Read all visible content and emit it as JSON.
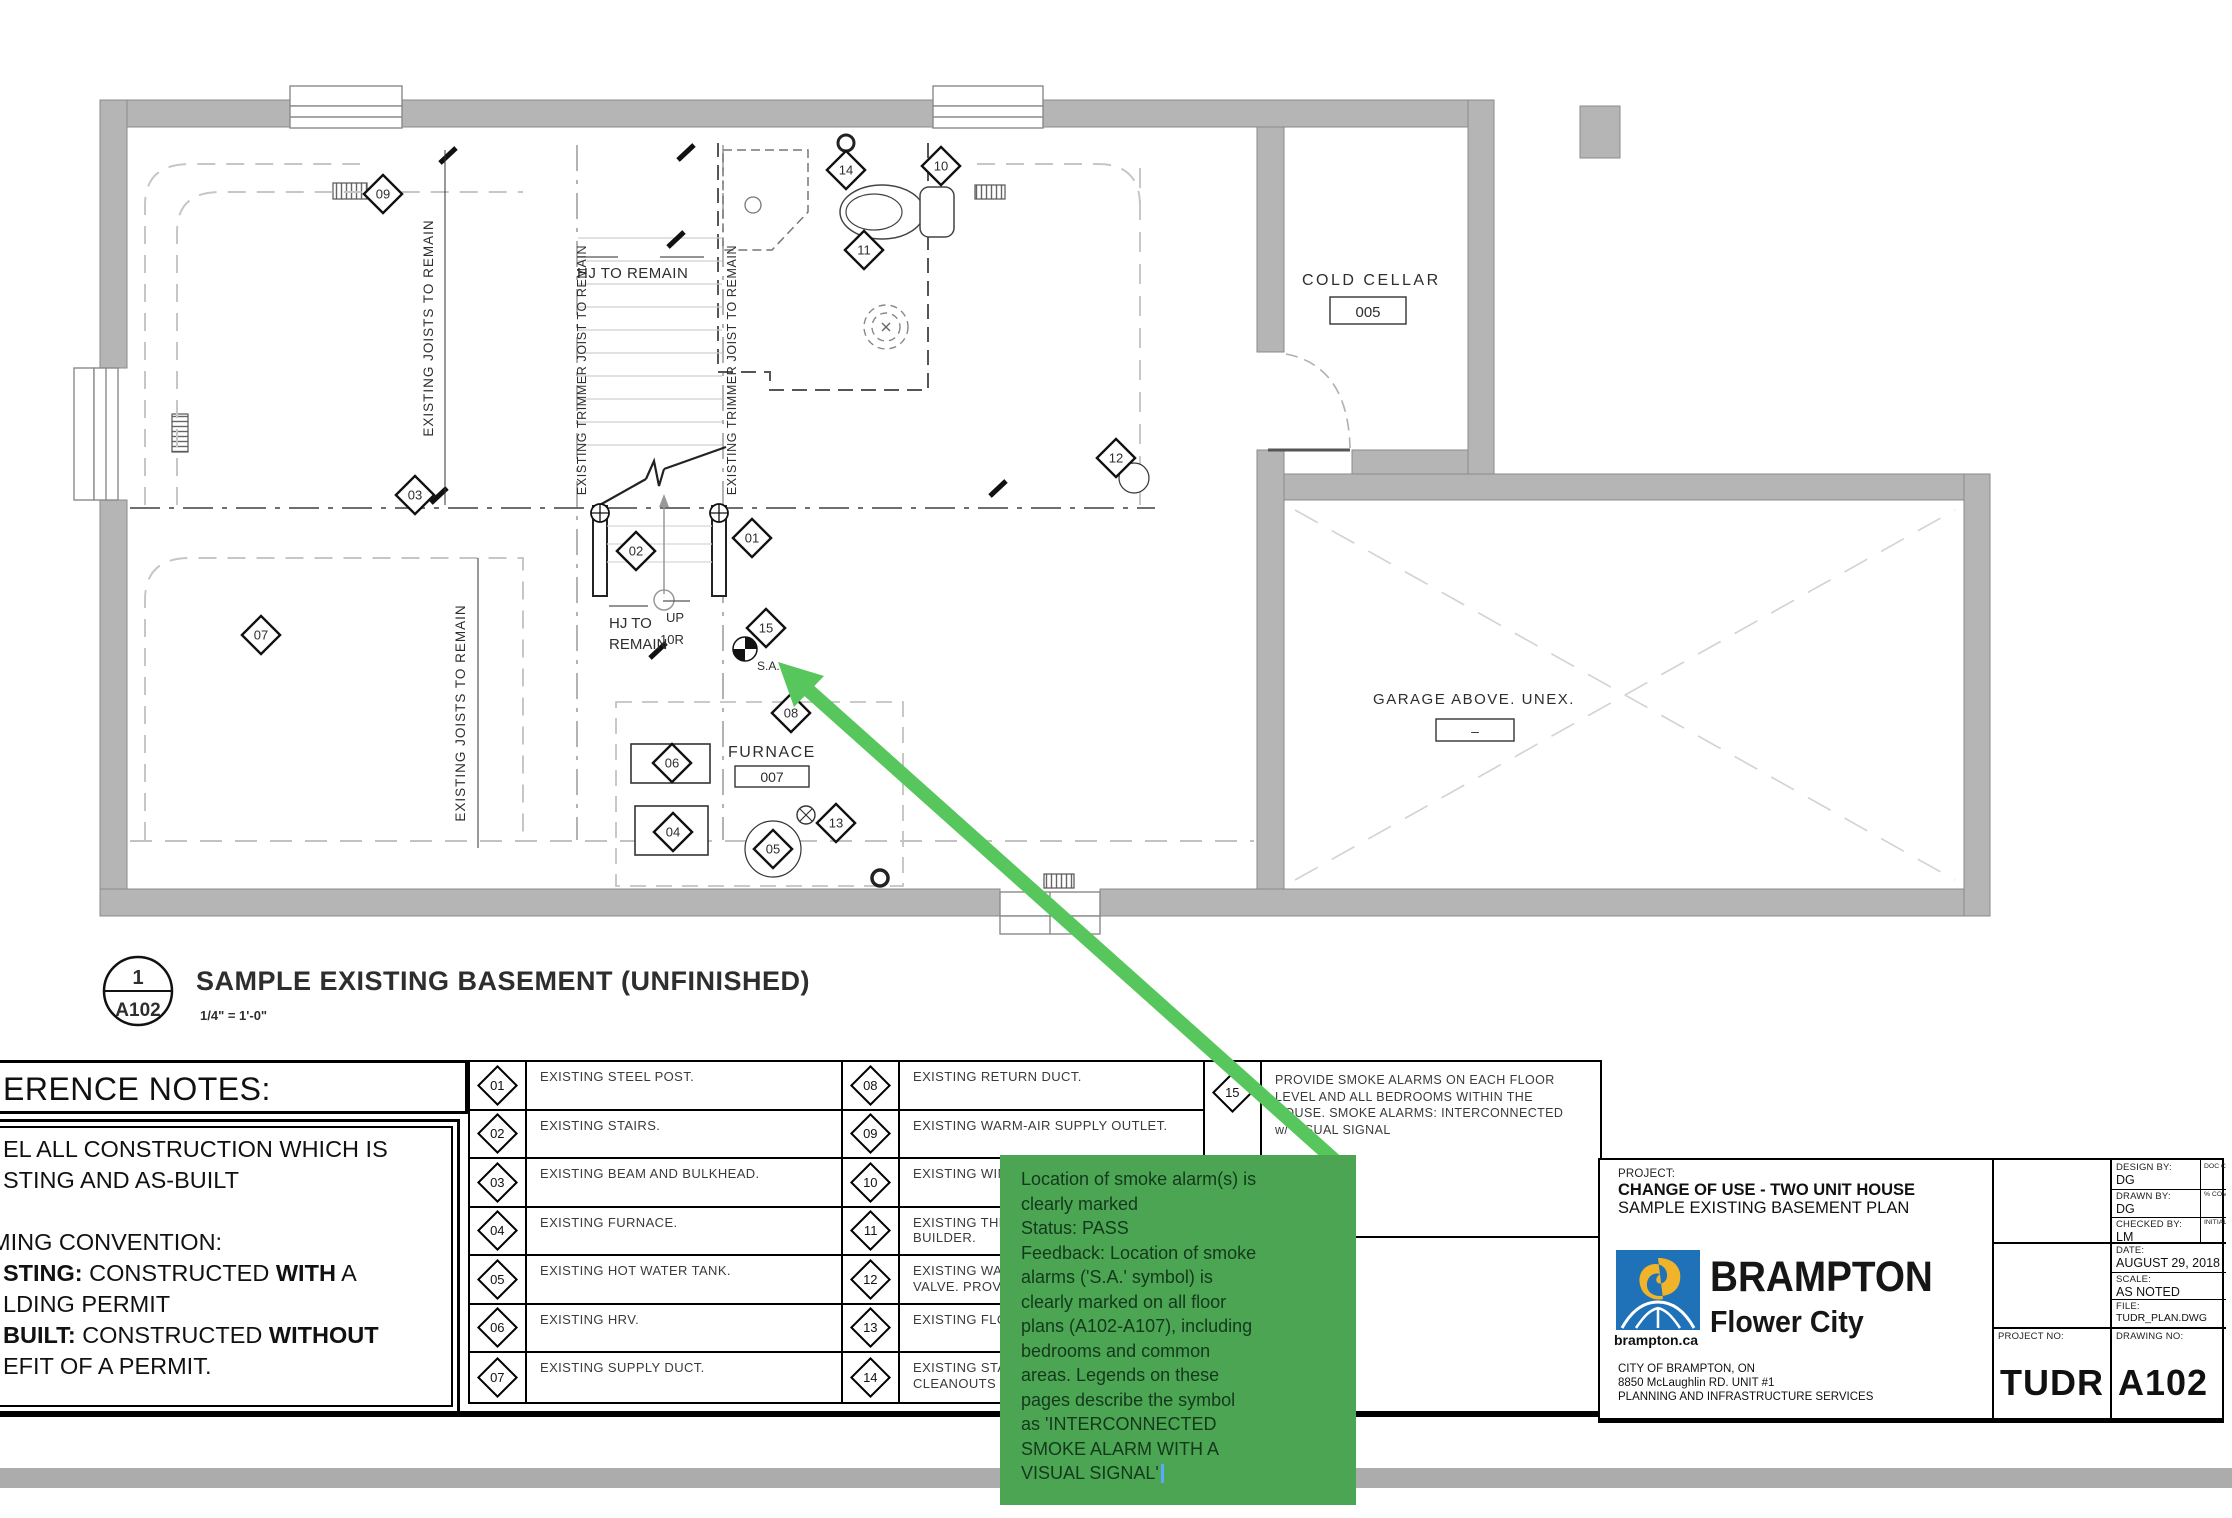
{
  "plan": {
    "title": "SAMPLE EXISTING BASEMENT (UNFINISHED)",
    "scale": "1/4\" = 1'-0\"",
    "sheet_no": "1",
    "sheet_id": "A102",
    "labels": {
      "cold_cellar": "COLD CELLAR",
      "cold_cellar_num": "005",
      "garage": "GARAGE ABOVE. UNEX.",
      "garage_num": "–",
      "furnace": "FURNACE",
      "furnace_num": "007",
      "hj_top": "HJ TO REMAIN",
      "hj_mid_1": "HJ TO",
      "hj_mid_2": "REMAIN",
      "up": "UP",
      "up_risers": "10R",
      "sa": "S.A.",
      "joists_1": "EXISTING JOISTS TO REMAIN",
      "joists_2": "EXISTING JOISTS TO REMAIN",
      "trimmer_1": "EXISTING TRIMMER JOIST TO REMAIN",
      "trimmer_2": "EXISTING TRIMMER JOIST TO REMAIN"
    },
    "markers": {
      "m01": "01",
      "m02": "02",
      "m03": "03",
      "m04": "04",
      "m05": "05",
      "m06": "06",
      "m07": "07",
      "m08": "08",
      "m09": "09",
      "m10": "10",
      "m11": "11",
      "m12": "12",
      "m13": "13",
      "m14": "14",
      "m15": "15"
    }
  },
  "notes": {
    "heading": "ERENCE NOTES:",
    "line1": "EL ALL CONSTRUCTION WHICH IS",
    "line2": "STING AND AS-BUILT",
    "line3": "MING CONVENTION:",
    "line4_b1": "STING:",
    "line4_t1": " CONSTRUCTED ",
    "line4_b2": "WITH",
    "line4_t2": " A",
    "line5": "LDING PERMIT",
    "line6_b1": "BUILT:",
    "line6_t1": " CONSTRUCTED ",
    "line6_b2": "WITHOUT",
    "line7": "EFIT OF A PERMIT."
  },
  "legend": {
    "col1": [
      {
        "num": "01",
        "label": "EXISTING STEEL POST."
      },
      {
        "num": "02",
        "label": "EXISTING STAIRS."
      },
      {
        "num": "03",
        "label": "EXISTING BEAM AND BULKHEAD."
      },
      {
        "num": "04",
        "label": "EXISTING FURNACE."
      },
      {
        "num": "05",
        "label": "EXISTING HOT WATER TANK."
      },
      {
        "num": "06",
        "label": "EXISTING HRV."
      },
      {
        "num": "07",
        "label": "EXISTING SUPPLY DUCT."
      }
    ],
    "col2": [
      {
        "num": "08",
        "line1": "EXISTING RETURN DUCT.",
        "line2": ""
      },
      {
        "num": "09",
        "line1": "EXISTING WARM-AIR SUPPLY OUTLET.",
        "line2": ""
      },
      {
        "num": "10",
        "line1": "EXISTING WINDO",
        "line2": ""
      },
      {
        "num": "11",
        "line1": "EXISTING THRE",
        "line2": "BUILDER."
      },
      {
        "num": "12",
        "line1": "EXISTING WATE",
        "line2": "VALVE. PROVID"
      },
      {
        "num": "13",
        "line1": "EXISTING FLOOR",
        "line2": ""
      },
      {
        "num": "14",
        "line1": "EXISTING STAC",
        "line2": "CLEANOUTS"
      }
    ],
    "note15": {
      "num": "15",
      "l1": "PROVIDE SMOKE ALARMS ON EACH FLOOR",
      "l2": "LEVEL AND ALL BEDROOMS WITHIN THE",
      "l3": "HOUSE. SMOKE ALARMS: INTERCONNECTED",
      "l4": "w/ VISUAL SIGNAL"
    }
  },
  "titleblock": {
    "project_label": "PROJECT:",
    "project_name": "CHANGE OF USE - TWO UNIT HOUSE",
    "project_sub": "SAMPLE EXISTING BASEMENT PLAN",
    "logo_brand": "BRAMPTON",
    "logo_tagline": "Flower City",
    "logo_url": "brampton.ca",
    "addr1": "CITY OF BRAMPTON, ON",
    "addr2": "8850 McLaughlin RD. UNIT #1",
    "addr3": "PLANNING AND INFRASTRUCTURE SERVICES",
    "design_by_label": "DESIGN BY:",
    "design_by": "DG",
    "drawn_by_label": "DRAWN BY:",
    "drawn_by": "DG",
    "checked_by_label": "CHECKED BY:",
    "checked_by": "LM",
    "date_label": "DATE:",
    "date": "AUGUST 29, 2018",
    "scale_label": "SCALE:",
    "scale": "AS NOTED",
    "file_label": "FILE:",
    "file": "TUDR_PLAN.DWG",
    "doc_control": "DOC CONTROL DATE:",
    "pct_complete": "% COMPLETE",
    "initial": "INITIAL:",
    "project_no_label": "PROJECT NO:",
    "drawing_no_label": "DRAWING NO:",
    "project_no": "TUDR",
    "drawing_no": "A102",
    "brand_blue": "#1f72b8",
    "brand_yellow": "#f0b32a"
  },
  "annotation": {
    "box_color": "#4BA552",
    "arrow_color": "#57c65c",
    "lines": [
      "Location of smoke alarm(s) is",
      "clearly marked",
      "Status: PASS",
      "Feedback: Location of smoke",
      "alarms ('S.A.' symbol) is",
      "clearly marked on all floor",
      "plans (A102-A107), including",
      "bedrooms and common",
      "areas. Legends on these",
      "pages describe the symbol",
      "as 'INTERCONNECTED",
      "SMOKE ALARM WITH A",
      "VISUAL SIGNAL'"
    ]
  }
}
